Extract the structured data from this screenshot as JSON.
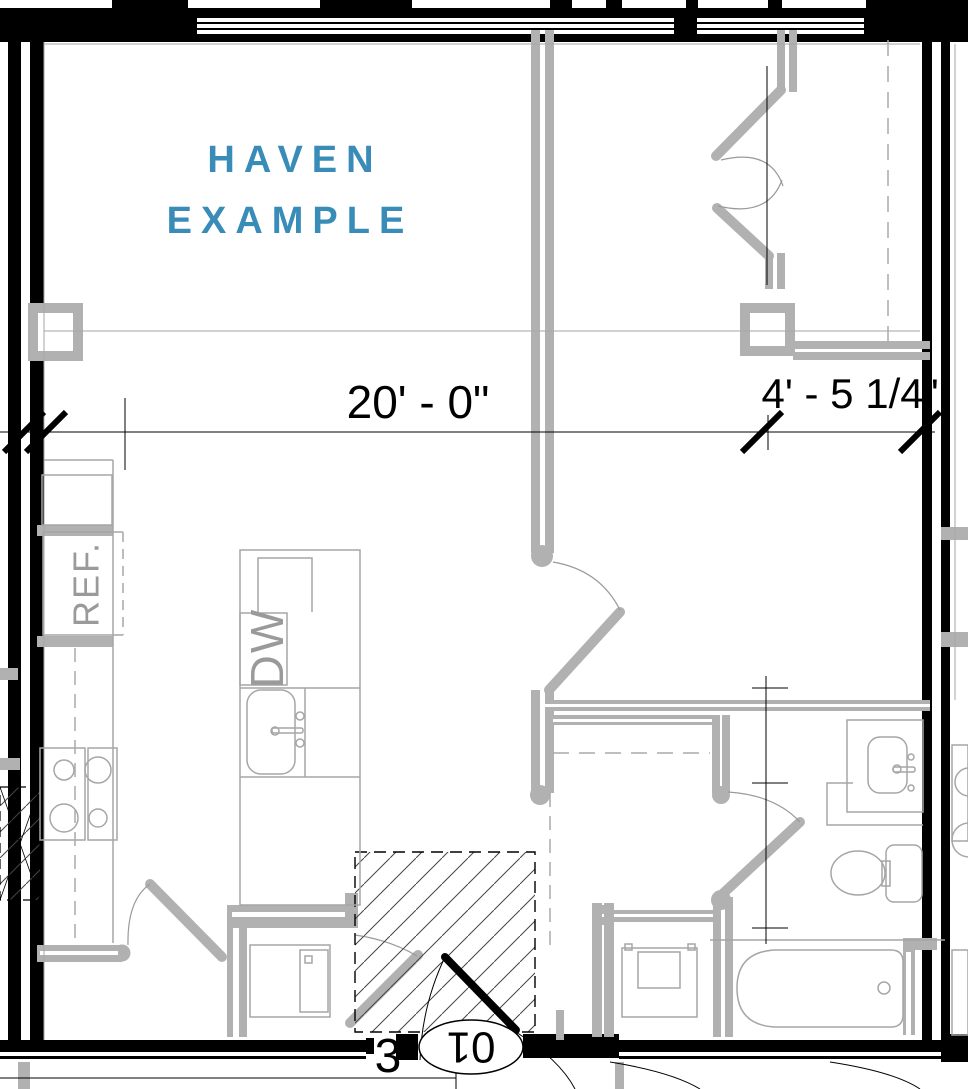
{
  "title": {
    "line1": "HAVEN",
    "line2": "EXAMPLE",
    "color": "#3a8cb8"
  },
  "dimensions": {
    "living_width": "20' - 0\"",
    "bedroom_width": "4' - 5 1/4\""
  },
  "appliance_labels": {
    "refrigerator": "REF.",
    "dishwasher": "DW"
  },
  "section_callout": {
    "detail_number": "3",
    "sheet_number": "01"
  },
  "colors": {
    "wall_black": "#000000",
    "wall_gray": "#b1b1b1",
    "fixture_line": "#a6a6a6",
    "title_blue": "#3a8cb8",
    "background": "#ffffff"
  }
}
